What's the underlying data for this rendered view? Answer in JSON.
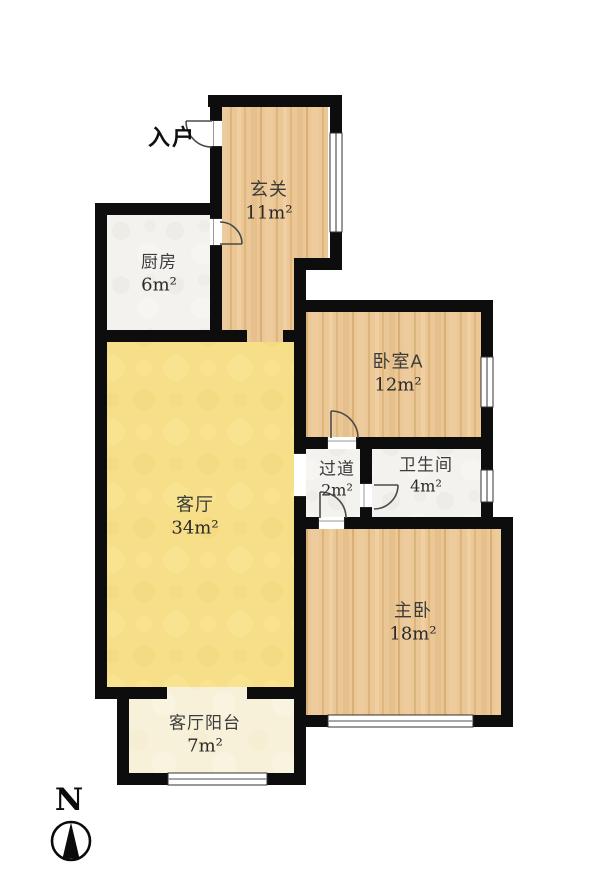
{
  "plan_title": "apartment-floor-plan",
  "entry": {
    "label": "入户"
  },
  "rooms": [
    {
      "name": "玄关",
      "area": "11m²"
    },
    {
      "name": "厨房",
      "area": "6m²"
    },
    {
      "name": "卧室A",
      "area": "12m²"
    },
    {
      "name": "过道",
      "area": "2m²"
    },
    {
      "name": "卫生间",
      "area": "4m²"
    },
    {
      "name": "客厅",
      "area": "34m²"
    },
    {
      "name": "主卧",
      "area": "18m²"
    },
    {
      "name": "客厅阳台",
      "area": "7m²"
    }
  ],
  "compass": {
    "letter": "N"
  },
  "colors": {
    "wall": "#0d0d0d",
    "wood_floor": "#eac795",
    "tile_floor": "#f3f2ee",
    "living_room_floor": "#f6df88",
    "balcony_floor": "#f7f1d9",
    "label_text": "#3a3a3a",
    "outside": "#ffffff"
  }
}
